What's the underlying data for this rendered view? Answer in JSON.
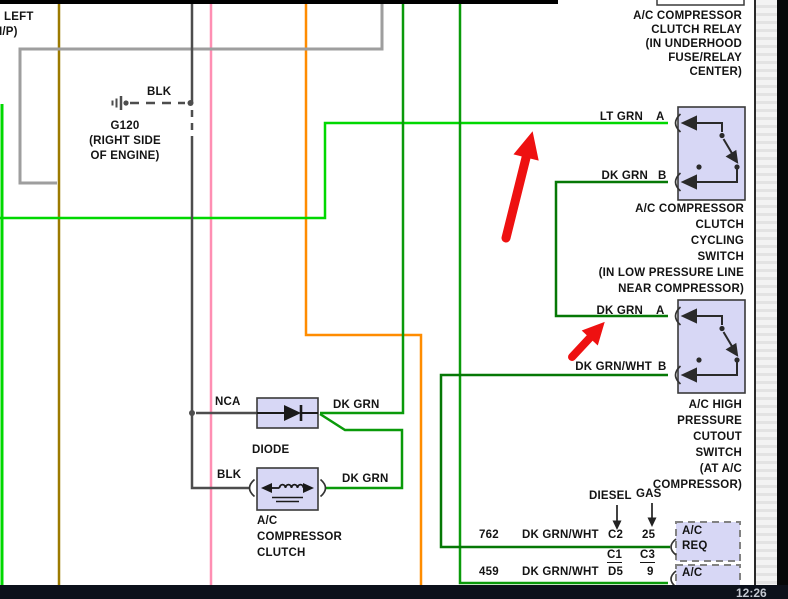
{
  "player": {
    "timestamp": "12:26"
  },
  "colors": {
    "lt_green": "#00d800",
    "mid_green": "#0a9a0a",
    "dk_green": "#067806",
    "orange": "#ff8c00",
    "pink": "#ff8fb3",
    "dark_yellow": "#9c7a00",
    "gray_wire": "#9e9e9e",
    "black_wire": "#4d4d4d",
    "symbol_ink": "#2a2a2a",
    "box_fill": "#d7d7f5",
    "box_border": "#3a3a3a",
    "annotation_red": "#ee1111"
  },
  "corner": {
    "line1": "LEFT",
    "line2": "I/P)"
  },
  "ground": {
    "wire": "BLK",
    "name": "G120",
    "loc1": "(RIGHT SIDE",
    "loc2": "OF ENGINE)"
  },
  "relay": {
    "title_lines": [
      "A/C COMPRESSOR",
      "CLUTCH RELAY",
      "(IN UNDERHOOD",
      "FUSE/RELAY",
      "CENTER)"
    ],
    "pin_a_wire": "LT GRN",
    "pin_a": "A",
    "pin_b_wire": "DK GRN",
    "pin_b": "B"
  },
  "cycling_switch": {
    "title_lines": [
      "A/C COMPRESSOR",
      "CLUTCH",
      "CYCLING",
      "SWITCH",
      "(IN LOW PRESSURE LINE",
      "NEAR COMPRESSOR)"
    ],
    "pin_a_wire": "DK GRN",
    "pin_a": "A",
    "pin_b_wire": "DK GRN/WHT",
    "pin_b": "B"
  },
  "pressure_switch": {
    "title_lines": [
      "A/C HIGH",
      "PRESSURE",
      "CUTOUT",
      "SWITCH",
      "(AT A/C",
      "COMPRESSOR)"
    ]
  },
  "diode": {
    "in_wire": "NCA",
    "label": "DIODE",
    "out_wire": "DK GRN"
  },
  "clutch": {
    "in_wire": "BLK",
    "out_wire": "DK GRN",
    "name_lines": [
      "A/C",
      "COMPRESSOR",
      "CLUTCH"
    ]
  },
  "connector_table": {
    "col_diesel": "DIESEL",
    "col_gas": "GAS",
    "rows": [
      {
        "circuit": "762",
        "color": "DK GRN/WHT",
        "diesel_pin": "C2",
        "gas_pin": "25"
      },
      {
        "circuit": "459",
        "color": "DK GRN/WHT",
        "diesel_pin": "D5",
        "gas_pin": "9"
      }
    ],
    "diesel_connector": "C1",
    "gas_connector": "C3",
    "module1_line1": "A/C",
    "module1_line2": "REQ",
    "module2_line1": "A/C"
  }
}
